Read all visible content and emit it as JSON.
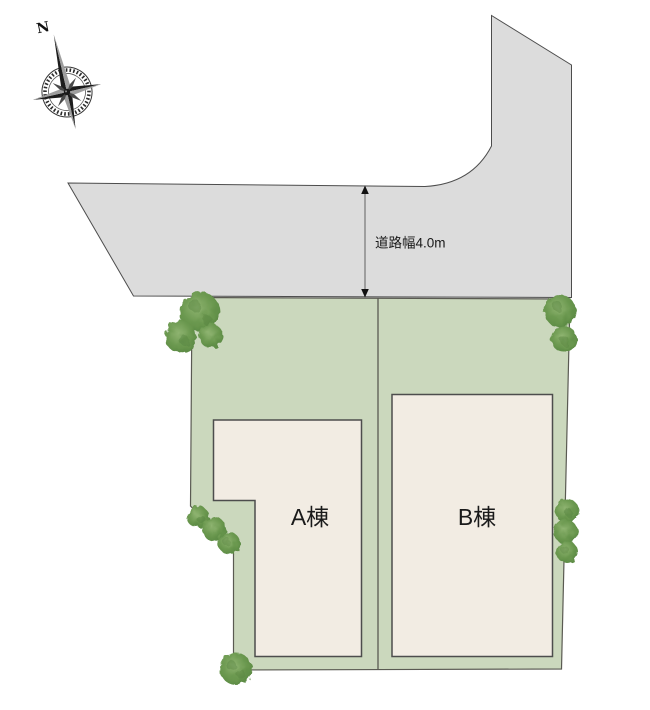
{
  "page": {
    "type": "site-plan-drawing",
    "background": "#ffffff"
  },
  "compass": {
    "north_label": "N"
  },
  "road": {
    "width_label": "道路幅4.0m"
  },
  "plot": {
    "buildings": [
      {
        "id": "A",
        "label": "A棟"
      },
      {
        "id": "B",
        "label": "B棟"
      }
    ]
  },
  "icons": [
    {
      "name": "compass-rose-icon",
      "meaning": "north direction indicator"
    },
    {
      "name": "tree-icon",
      "meaning": "landscape tree / shrub"
    },
    {
      "name": "dimension-arrow-icon",
      "meaning": "road width measurement arrow"
    }
  ],
  "colors": {
    "road_fill": "#dcdcdc",
    "road_border": "#4d4d4d",
    "plot_fill": "#cbd8bd",
    "plot_border": "#5a5a52",
    "building_fill": "#f2ece3",
    "building_border": "#4d4d4d",
    "divider_line": "#5a5a52",
    "tree_green": "#6d9a51",
    "tree_dark": "#4e7a38",
    "tree_light": "#8fb471",
    "dimension_line": "#8a8a8a",
    "arrowhead": "#111111",
    "label_text": "#1a1a1a",
    "compass_dark": "#2b2b2b"
  }
}
